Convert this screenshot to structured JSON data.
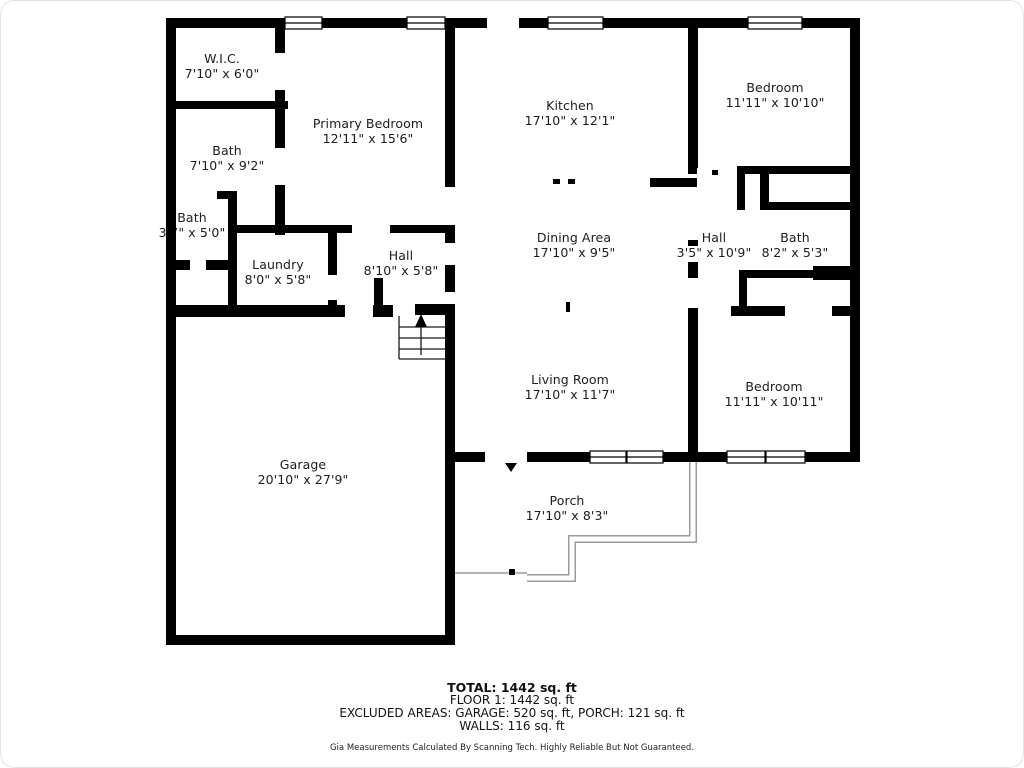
{
  "colors": {
    "wall": "#000000",
    "porch_outline": "#9b9b9b",
    "text": "#1c1c1c"
  },
  "rooms": [
    {
      "id": "wic",
      "name": "W.I.C.",
      "dims": "7'10\" x 6'0\""
    },
    {
      "id": "bath-primary",
      "name": "Bath",
      "dims": "7'10\" x 9'2\""
    },
    {
      "id": "bath-small",
      "name": "Bath",
      "dims": "3'7\" x 5'0\""
    },
    {
      "id": "primary-bedroom",
      "name": "Primary Bedroom",
      "dims": "12'11\" x 15'6\""
    },
    {
      "id": "kitchen",
      "name": "Kitchen",
      "dims": "17'10\" x 12'1\""
    },
    {
      "id": "bedroom-top-right",
      "name": "Bedroom",
      "dims": "11'11\" x 10'10\""
    },
    {
      "id": "hall-right",
      "name": "Hall",
      "dims": "3'5\" x 10'9\""
    },
    {
      "id": "bath-hall",
      "name": "Bath",
      "dims": "8'2\" x 5'3\""
    },
    {
      "id": "laundry",
      "name": "Laundry",
      "dims": "8'0\" x 5'8\""
    },
    {
      "id": "hall-center",
      "name": "Hall",
      "dims": "8'10\" x 5'8\""
    },
    {
      "id": "dining-area",
      "name": "Dining Area",
      "dims": "17'10\" x 9'5\""
    },
    {
      "id": "living-room",
      "name": "Living Room",
      "dims": "17'10\" x 11'7\""
    },
    {
      "id": "bedroom-bottom-right",
      "name": "Bedroom",
      "dims": "11'11\" x 10'11\""
    },
    {
      "id": "garage",
      "name": "Garage",
      "dims": "20'10\" x 27'9\""
    },
    {
      "id": "porch",
      "name": "Porch",
      "dims": "17'10\" x 8'3\""
    }
  ],
  "footer": {
    "total": "TOTAL: 1442 sq. ft",
    "floor": "FLOOR 1: 1442 sq. ft",
    "excluded": "EXCLUDED AREAS: GARAGE: 520 sq. ft, PORCH: 121 sq. ft",
    "walls": "WALLS: 116 sq. ft",
    "disclaimer": "Gia Measurements Calculated By Scanning Tech. Highly Reliable But Not Guaranteed."
  }
}
